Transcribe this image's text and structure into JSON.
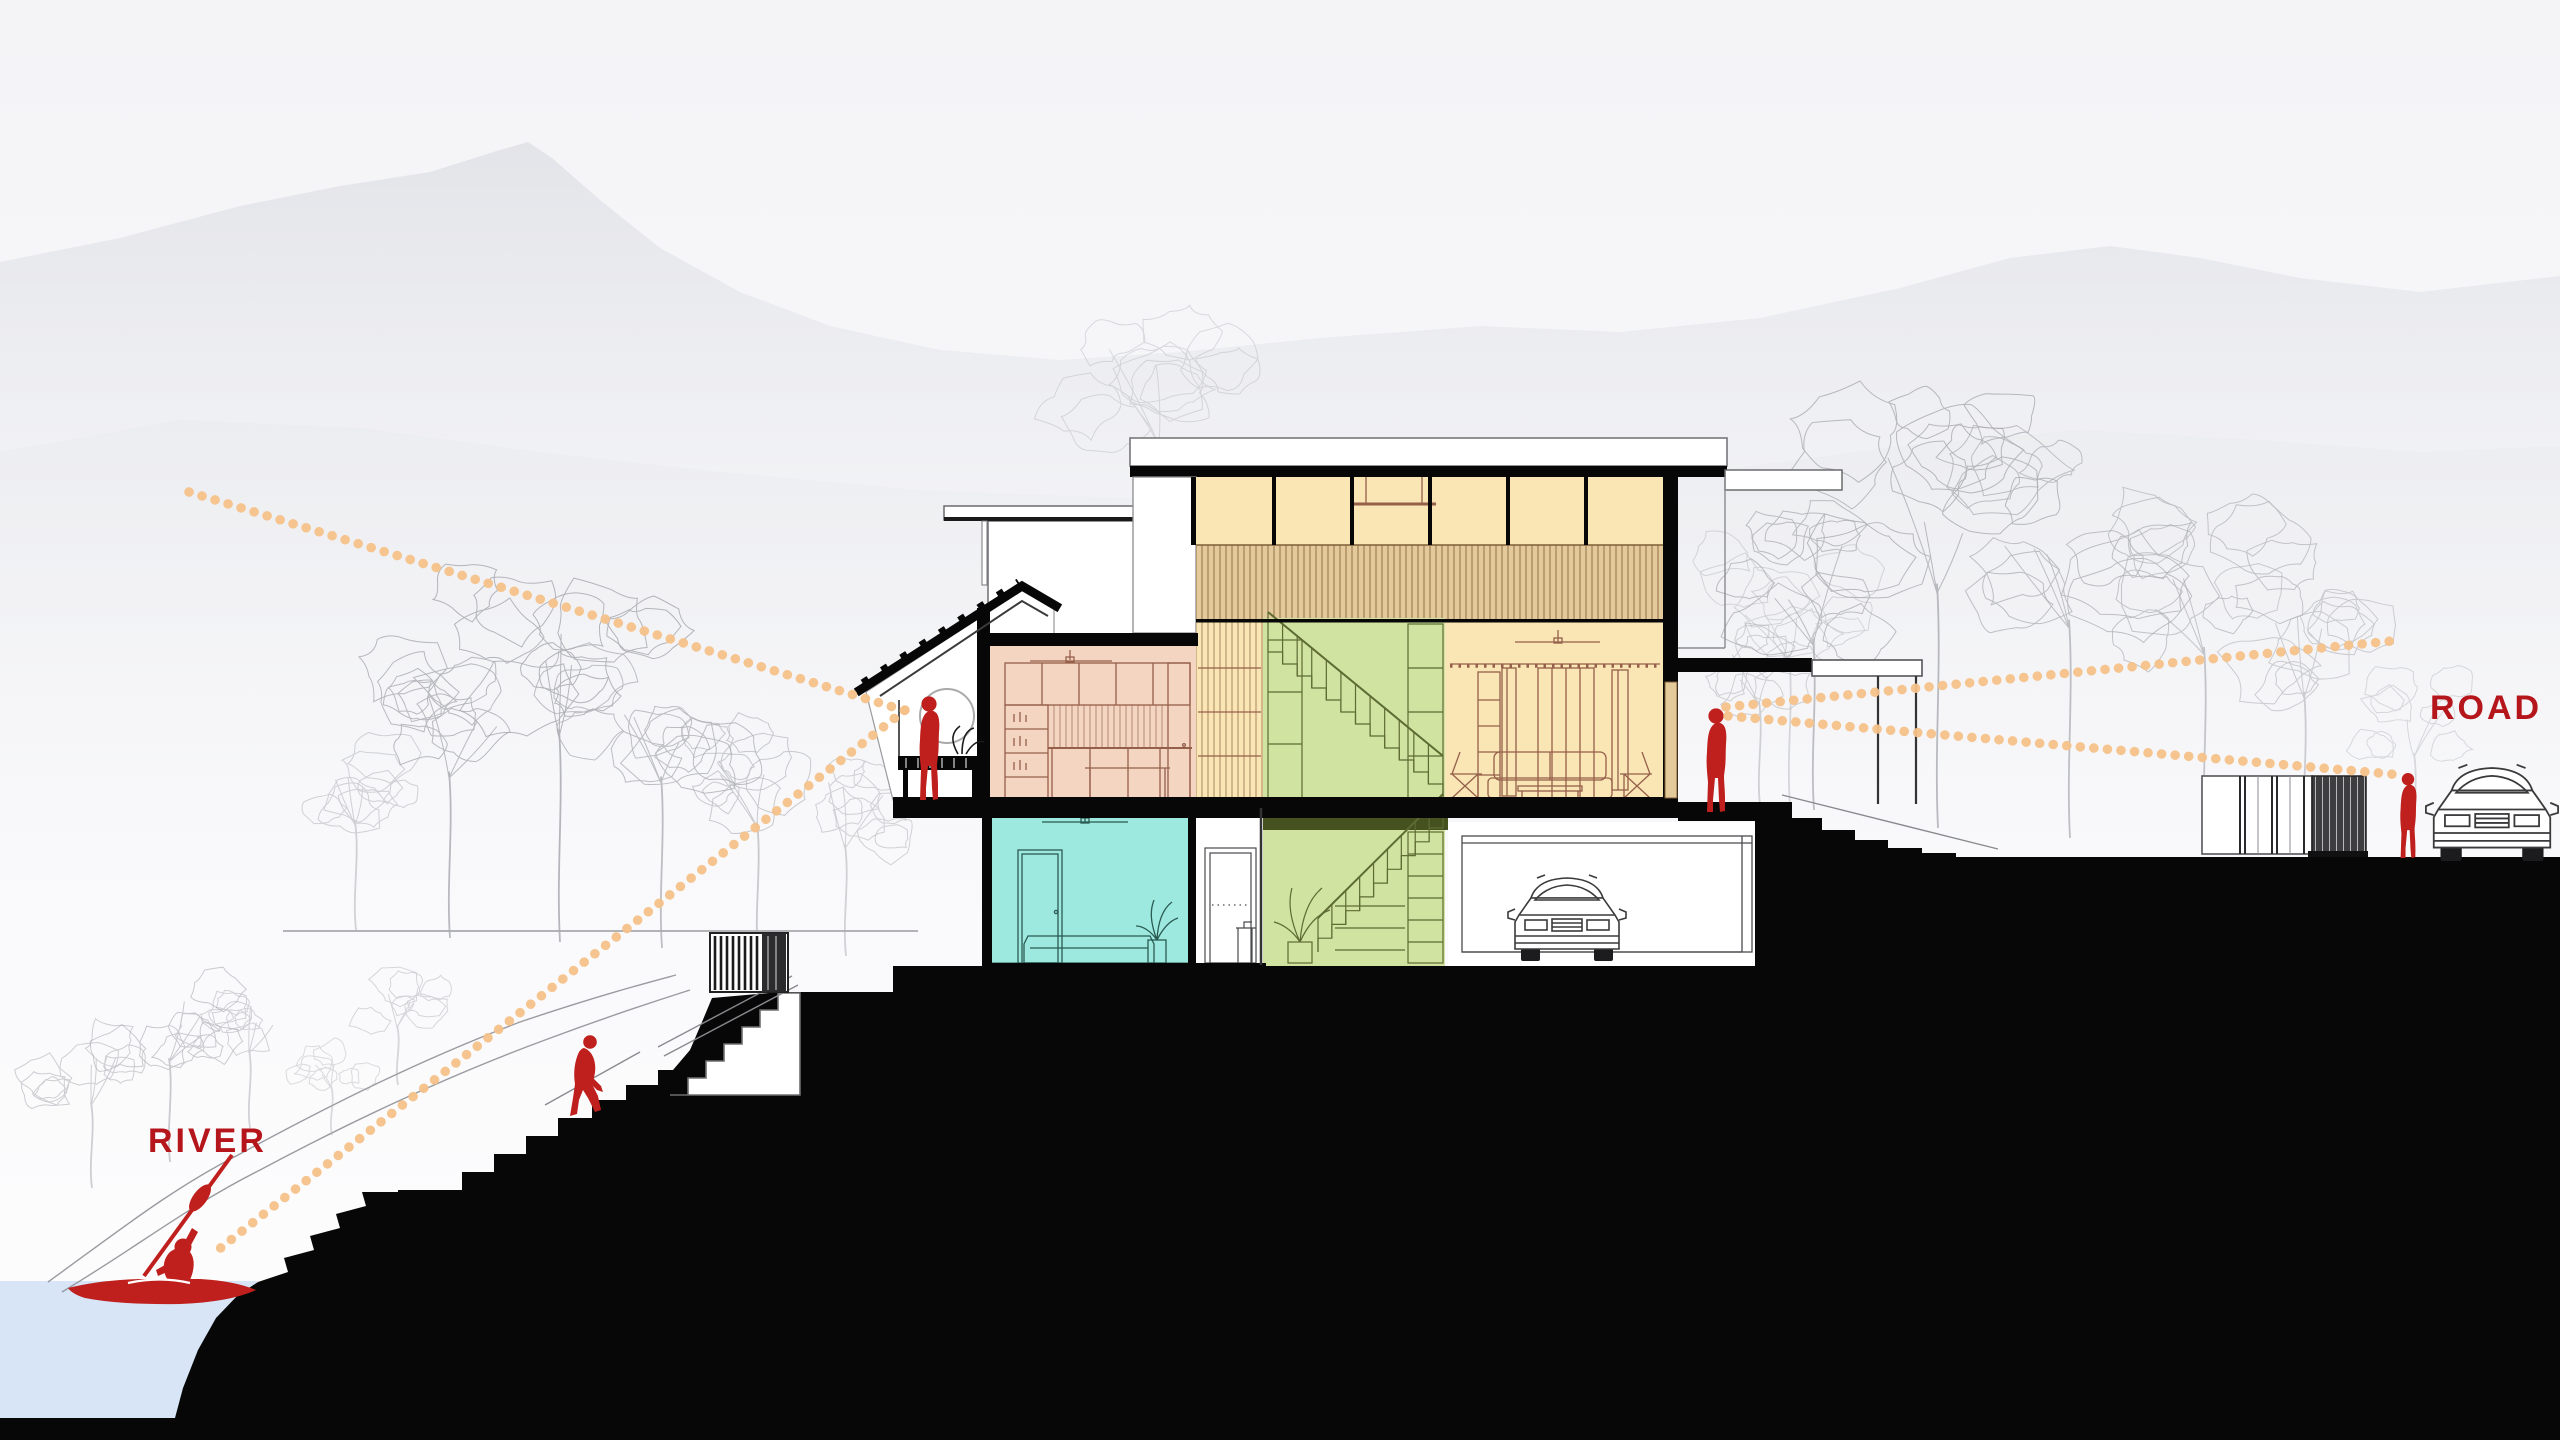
{
  "diagram": {
    "kind": "architectural-section-diagram",
    "scene": "hillside house section between river and road with sightlines"
  },
  "annotations": {
    "river": "RIVER",
    "road": "ROAD"
  },
  "colors": {
    "sky": "#F5F5F7",
    "mountain-far": "#E2E3E8",
    "mountain-near": "#EBECEF",
    "sketch": "#A9AAB0",
    "ground": "#070707",
    "water": "#D7E5F7",
    "dots": "#F4C189",
    "label-red": "#B5161B",
    "figure-red": "#BF201D",
    "room-peach": "#F3D5C2",
    "room-teal": "#9DE9DF",
    "room-orange": "#FAE5B5",
    "slat-tan": "#E4C99B",
    "slat-stroke": "#7F5F36",
    "room-green": "#D0E3A1",
    "olive": "#45511F",
    "int-brown": "#95604A",
    "int-teal": "#2A5A52",
    "int-green": "#5E6B33"
  },
  "sightlines": [
    {
      "name": "view-balcony-to-mountain",
      "x1": 189,
      "y1": 492,
      "x2": 916,
      "y2": 714
    },
    {
      "name": "view-balcony-to-river",
      "x1": 905,
      "y1": 710,
      "x2": 218,
      "y2": 1250
    },
    {
      "name": "view-terrace-to-road-upper",
      "x1": 1726,
      "y1": 707,
      "x2": 2392,
      "y2": 641
    },
    {
      "name": "view-terrace-to-road-lower",
      "x1": 1728,
      "y1": 716,
      "x2": 2402,
      "y2": 775
    }
  ],
  "figures": [
    {
      "id": "kayaker",
      "pose": "paddling kayak on river"
    },
    {
      "id": "stair-climber",
      "pose": "walking up rock steps from river"
    },
    {
      "id": "balcony-person",
      "pose": "standing on upper balcony facing river"
    },
    {
      "id": "terrace-person",
      "pose": "standing on road-side terrace"
    },
    {
      "id": "road-person",
      "pose": "standing at road beside car"
    }
  ],
  "rooms": [
    {
      "id": "bedroom-upper",
      "fill": "room-peach"
    },
    {
      "id": "bedroom-lower",
      "fill": "room-teal"
    },
    {
      "id": "living-double-height",
      "fill": "room-orange"
    },
    {
      "id": "stair-core",
      "fill": "room-green"
    },
    {
      "id": "garage",
      "fill": "white"
    }
  ],
  "objects": [
    {
      "id": "garage-car"
    },
    {
      "id": "road-car"
    },
    {
      "id": "river-gate"
    },
    {
      "id": "road-gate"
    },
    {
      "id": "terrace-pergola"
    }
  ]
}
